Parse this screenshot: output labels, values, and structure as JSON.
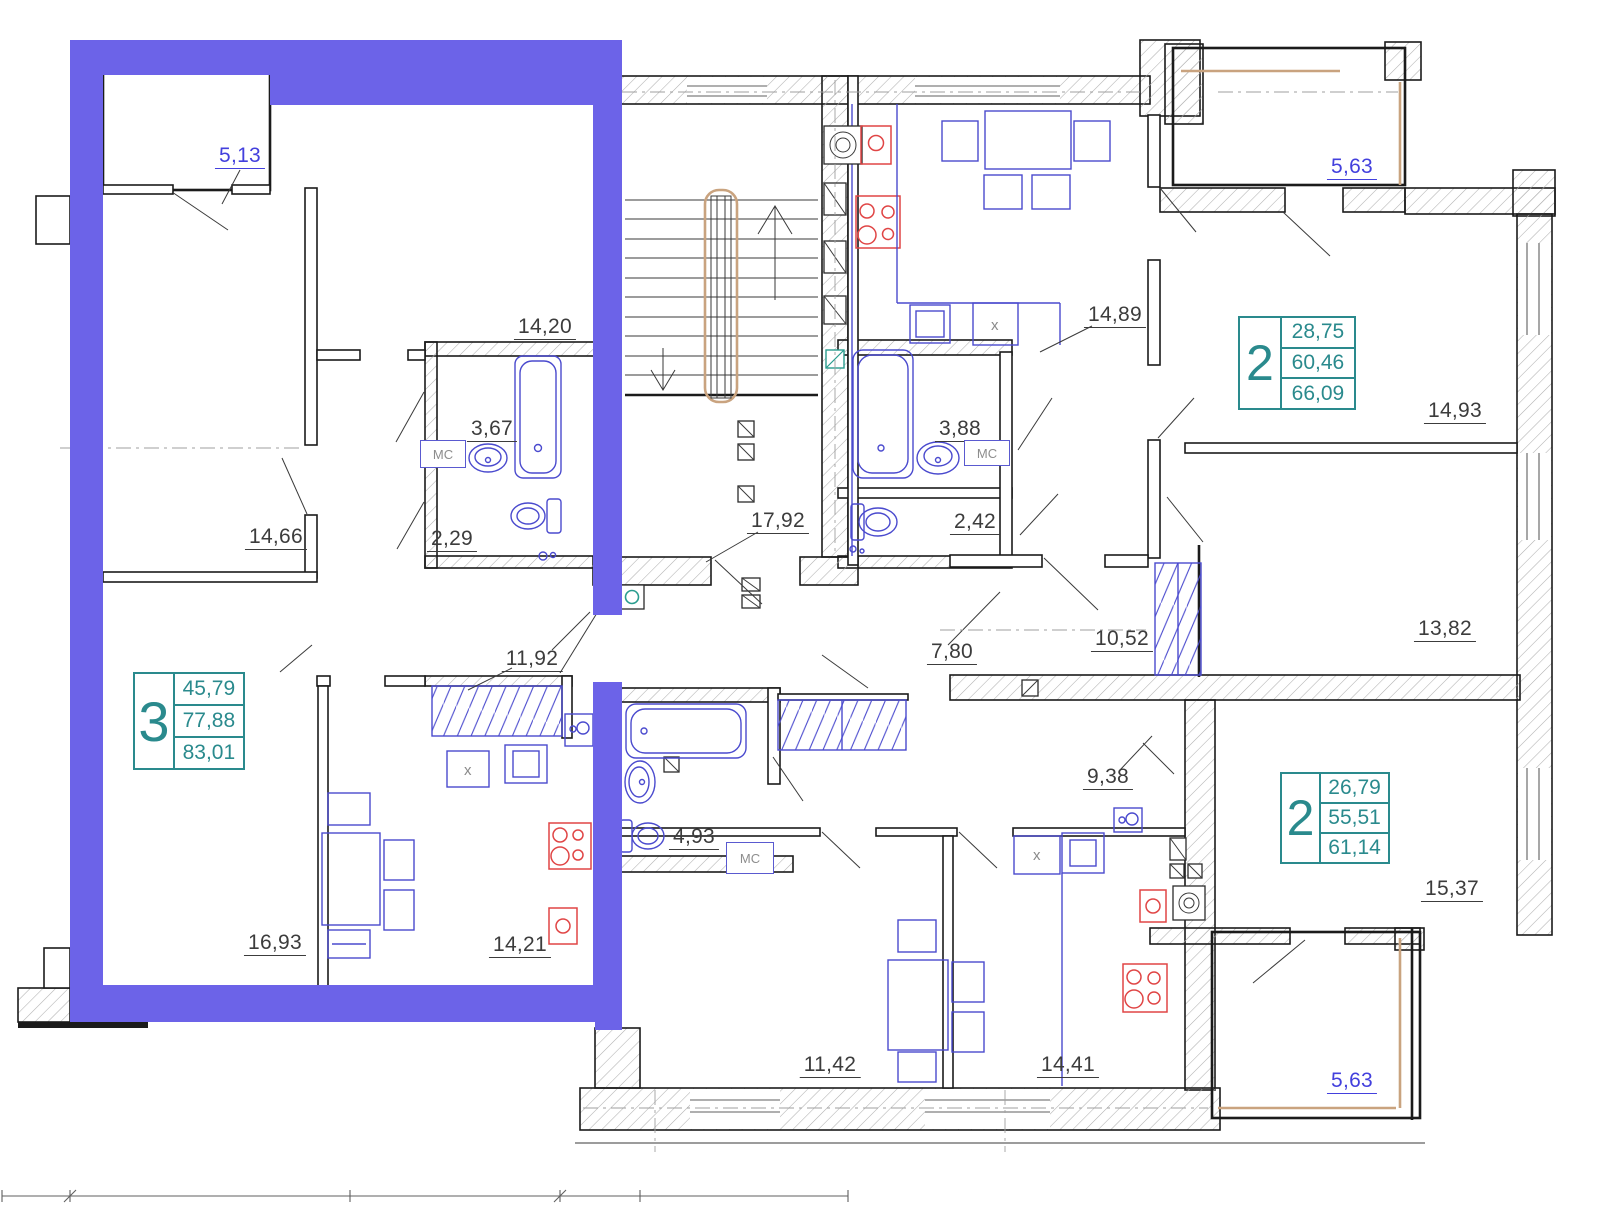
{
  "colors": {
    "highlight": "#6c63e8",
    "apartment_accent_teal": "#2a8a8d",
    "furniture_blue": "#4a4ace",
    "fixture_red": "#e04545",
    "wall": "#1b1b1b",
    "label_gray": "#3c3c3c",
    "label_blue": "#4340dd",
    "railing_tan": "#c9a37f"
  },
  "apartments": [
    {
      "rooms": "3",
      "area_living": "45,79",
      "area": "77,88",
      "area_total": "83,01"
    },
    {
      "rooms": "2",
      "area_living": "28,75",
      "area": "60,46",
      "area_total": "66,09"
    },
    {
      "rooms": "2",
      "area_living": "26,79",
      "area": "55,51",
      "area_total": "61,14"
    }
  ],
  "room_labels": [
    {
      "room": "loggia-top-left",
      "text": "5,13"
    },
    {
      "room": "bedroom-top-left",
      "text": "14,20"
    },
    {
      "room": "bathroom-left",
      "text": "3,67"
    },
    {
      "room": "wc-left",
      "text": "2,29"
    },
    {
      "room": "living-room-left",
      "text": "14,66"
    },
    {
      "room": "stairwell",
      "text": "17,92"
    },
    {
      "room": "bathroom-mid",
      "text": "3,88"
    },
    {
      "room": "wc-mid",
      "text": "2,42"
    },
    {
      "room": "kitchen-living-top",
      "text": "14,89"
    },
    {
      "room": "loggia-top-right",
      "text": "5,63"
    },
    {
      "room": "bedroom-right-upper",
      "text": "14,93"
    },
    {
      "room": "bedroom-right-middle",
      "text": "13,82"
    },
    {
      "room": "wardrobe-top-apt",
      "text": "10,52"
    },
    {
      "room": "hall-top-apt",
      "text": "7,80"
    },
    {
      "room": "closet-left-apt",
      "text": "11,92"
    },
    {
      "room": "room-bottom-left",
      "text": "16,93"
    },
    {
      "room": "kitchen-left-apt",
      "text": "14,21"
    },
    {
      "room": "hall-bottom-apt",
      "text": "9,38"
    },
    {
      "room": "bathroom-bottom-apt",
      "text": "4,93"
    },
    {
      "room": "room-bottom-middle",
      "text": "11,42"
    },
    {
      "room": "kitchen-bottom-apt",
      "text": "14,41"
    },
    {
      "room": "bedroom-bottom-right",
      "text": "15,37"
    },
    {
      "room": "loggia-bottom-right",
      "text": "5,63"
    }
  ],
  "fixtures": {
    "cabinet_label": "MC",
    "sink_label": "x"
  }
}
